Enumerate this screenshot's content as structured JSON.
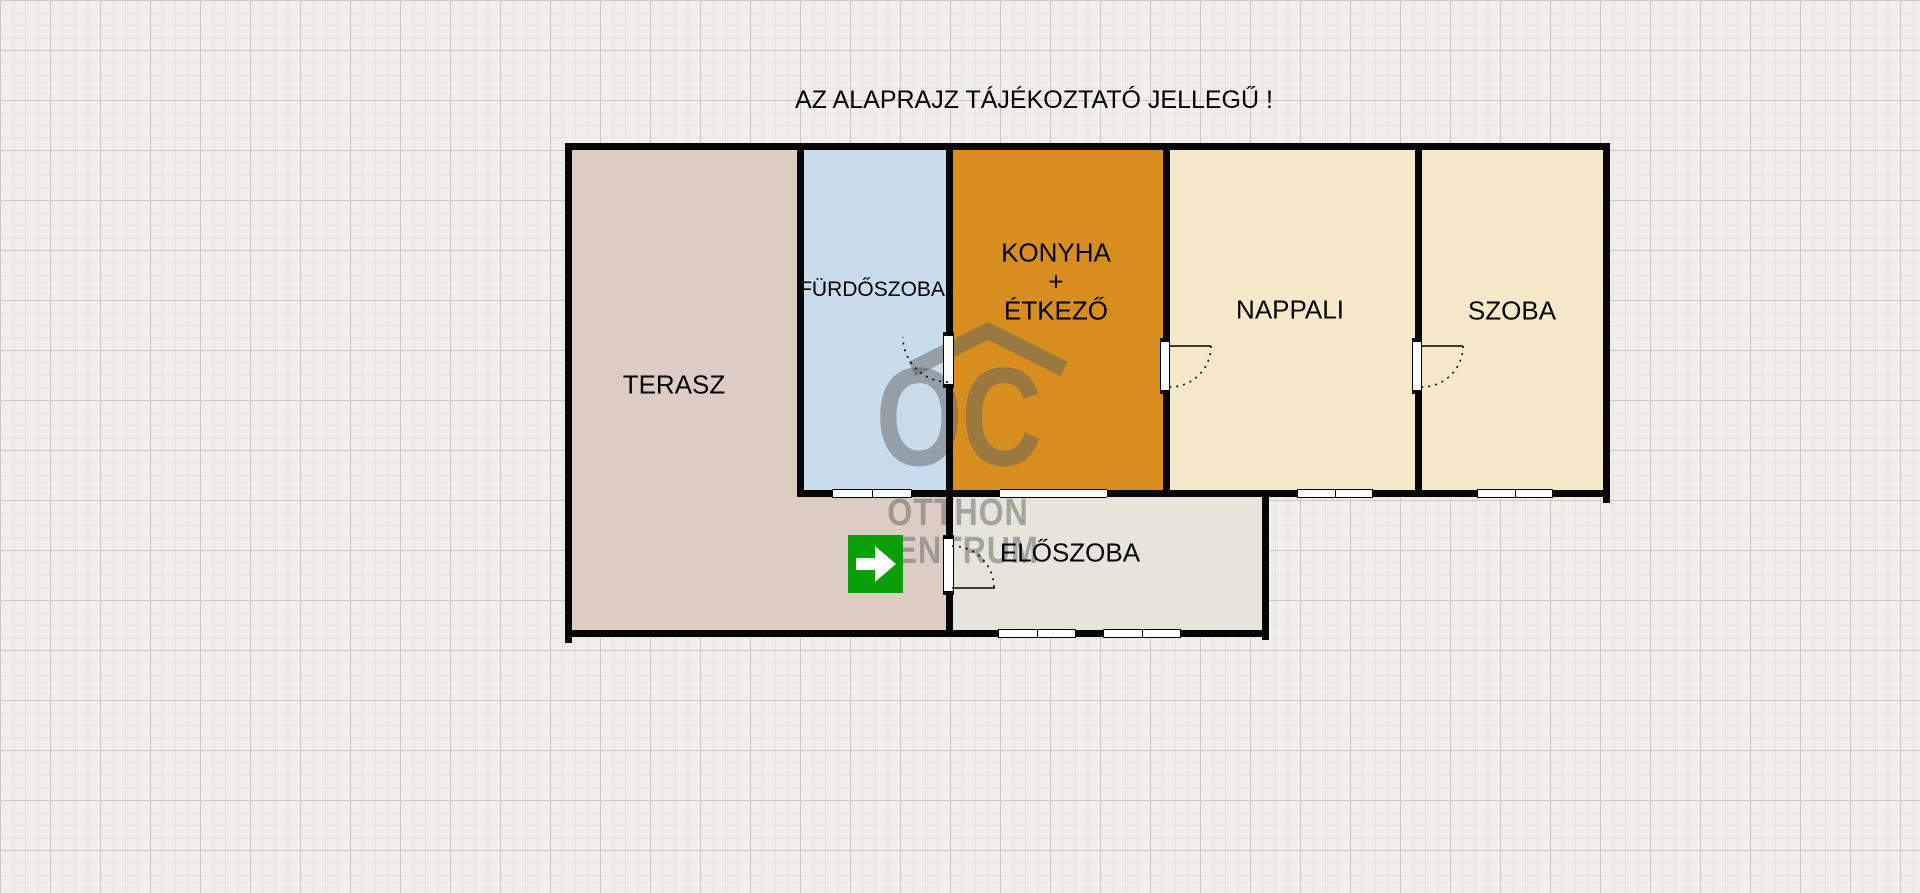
{
  "title": "AZ ALAPRAJZ TÁJÉKOZTATÓ JELLEGŰ !",
  "rooms": [
    {
      "id": "terasz",
      "label": "TERASZ",
      "color": "#ddccc1"
    },
    {
      "id": "furdoszoba",
      "label": "FÜRDŐSZOBA",
      "color": "#c9dcec"
    },
    {
      "id": "konyha",
      "label": "KONYHA",
      "label2": "+",
      "label3": "ÉTKEZŐ",
      "color": "#d88e1f"
    },
    {
      "id": "nappali",
      "label": "NAPPALI",
      "color": "#f6e9c9"
    },
    {
      "id": "szoba",
      "label": "SZOBA",
      "color": "#f6e9c9"
    },
    {
      "id": "eloszoba",
      "label": "ELŐSZOBA",
      "color": "#e6e5da"
    }
  ],
  "watermark": {
    "logo": "OC",
    "line1": "OTTHON",
    "line2": "CENTRUM",
    "color": "rgba(95,97,99,0.5)"
  },
  "entrance": {
    "icon": "arrow-right",
    "color": "#0aa00a"
  },
  "colors": {
    "wall": "#060606",
    "canvas": "#f0efe9",
    "label_text": "#000000"
  }
}
